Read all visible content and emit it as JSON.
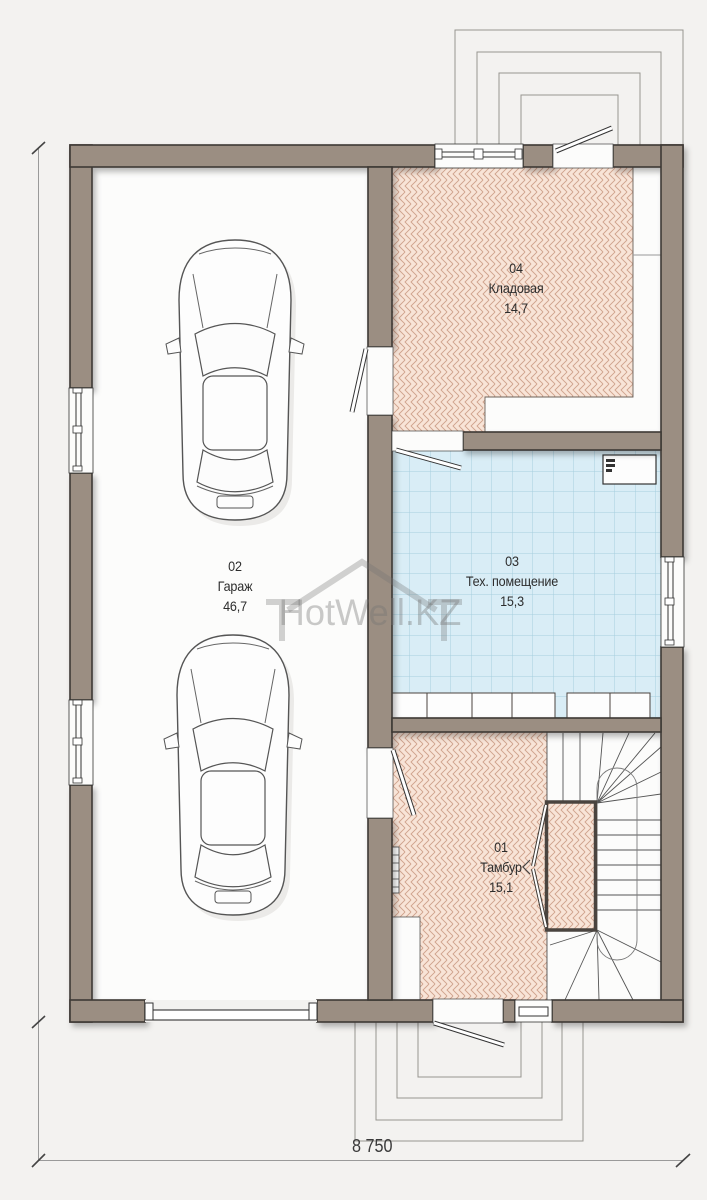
{
  "watermark": {
    "text": "HotWell.KZ"
  },
  "rooms": [
    {
      "number": "02",
      "name": "Гараж",
      "area": "46,7"
    },
    {
      "number": "04",
      "name": "Кладовая",
      "area": "14,7"
    },
    {
      "number": "03",
      "name": "Тех. помещение",
      "area": "15,3"
    },
    {
      "number": "01",
      "name": "Тамбур",
      "area": "15,1"
    }
  ],
  "dimensions": {
    "overall_width": "8 750"
  },
  "colors": {
    "wall": "#9b8e82",
    "wall_outline": "#3e3934",
    "tile_herringbone": "#f8e4d7",
    "tile_herringbone_line": "#cfa28c",
    "tile_blue": "#d9edf6",
    "tile_blue_line": "#a6cede",
    "background": "#f3f2f0",
    "floor": "#fcfcfb"
  }
}
